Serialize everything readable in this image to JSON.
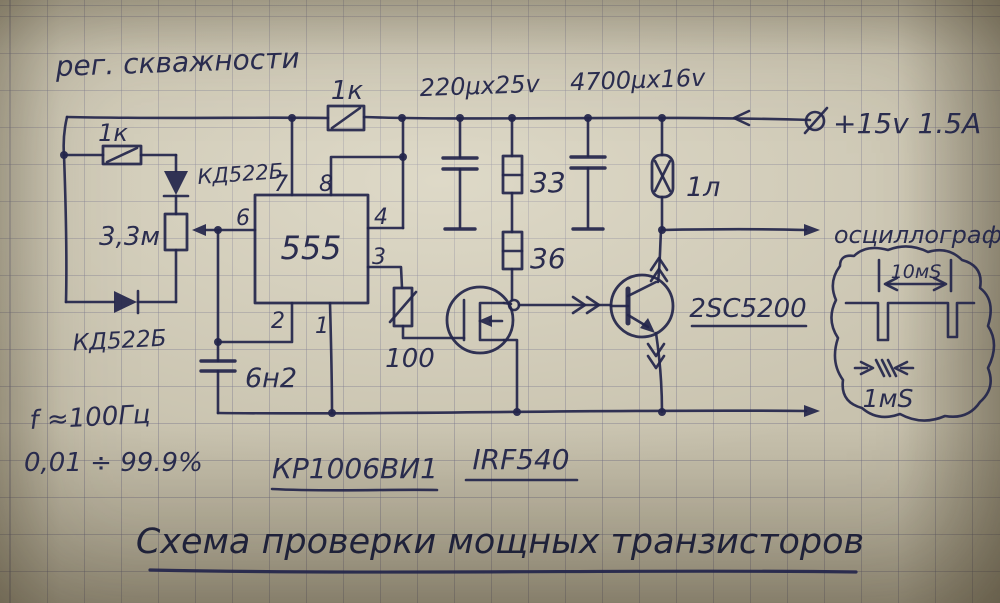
{
  "header": {
    "duty_note": "рег. скважности"
  },
  "power": {
    "supply": "+15v 1.5A",
    "lamp": "1л"
  },
  "components": {
    "r_top": "1к",
    "r_left": "1к",
    "d_top": "КД522Б",
    "d_bottom": "КД522Б",
    "pot": "3,3м",
    "c_timing": "6н2",
    "c_filter_1": "220μx25v",
    "c_filter_2": "4700μx16v",
    "r_33": "33",
    "r_36": "36",
    "r_100": "100",
    "ic_marking": "555",
    "ic_part": "КР1006ВИ1",
    "mosfet_part": "IRF540",
    "bjt_part": "2SC5200"
  },
  "pins": {
    "p1": "1",
    "p2": "2",
    "p3": "3",
    "p4": "4",
    "p6": "6",
    "p7": "7",
    "p8": "8"
  },
  "notes": {
    "freq": "f ≈100Гц",
    "duty_range": "0,01 ÷ 99.9%"
  },
  "oscilloscope": {
    "label": "осциллограф",
    "period": "10мS",
    "pulse_width": "1мS"
  },
  "title": {
    "text": "Схема проверки мощных транзисторов"
  }
}
